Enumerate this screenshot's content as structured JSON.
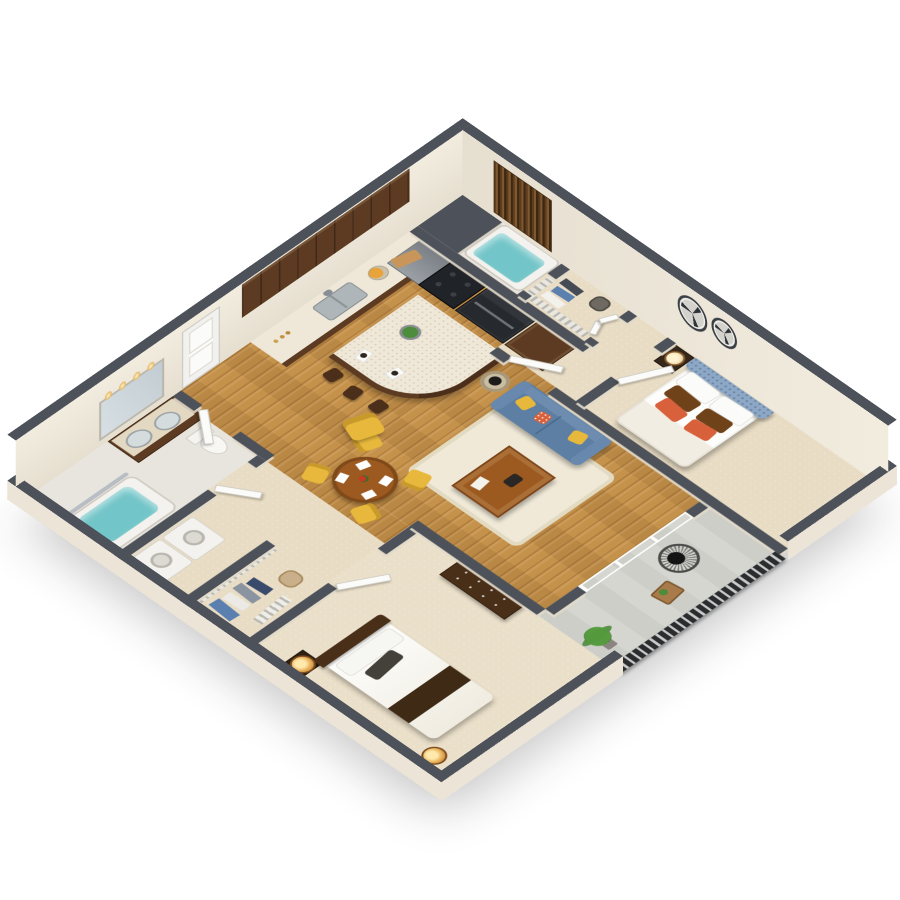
{
  "scene": {
    "type": "3d-floorplan-dollhouse-render",
    "view": "isometric cutaway, two-bedroom two-bath apartment",
    "background": "#ffffff",
    "visible_text": "none"
  },
  "palette": {
    "wall_top_gray": "#4d525a",
    "wall_face_cream": "#efe9dd",
    "wood_floor": "#c5924c",
    "carpet_beige": "#e8dcc4",
    "carpet_bedroom2": "#eadfc9",
    "tile_light": "#e8e5de",
    "patio_concrete": "#d6d6d1",
    "sofa_blue": "#5d7fa3",
    "headboard_blue": "#8ca8c6",
    "chair_yellow": "#e7b83b",
    "tub_water_teal": "#72c5c8",
    "railing_black": "#2a2c2e",
    "fridge_black": "#26292d",
    "cabinet_walnut": "#5d3b22",
    "countertop_cream": "#efe8d8",
    "rug_cream": "#f0e9d8",
    "table_wood": "#9c5a20",
    "runner_brown": "#3e2a15",
    "lamp_gold": "#c07c2e",
    "pillow_orange": "#d8603a",
    "pillow_brown": "#6f421a",
    "plant_green": "#4c8c3a",
    "steel": "#9aa0a5",
    "curtain_brown": "#5e3d1e"
  },
  "rooms": [
    {
      "id": "kitchen",
      "name": "Kitchen",
      "floor": "hardwood"
    },
    {
      "id": "dining-area",
      "name": "Dining Area",
      "floor": "hardwood"
    },
    {
      "id": "living-room",
      "name": "Living Room",
      "floor": "hardwood with cream rug"
    },
    {
      "id": "master-bedroom",
      "name": "Master Bedroom",
      "floor": "beige carpet"
    },
    {
      "id": "master-bathroom",
      "name": "Bathroom 2 (tub/shower)",
      "floor": "tile"
    },
    {
      "id": "master-closet",
      "name": "Walk-in Closet 2 (wire shelving)",
      "floor": "carpet"
    },
    {
      "id": "utility-closet",
      "name": "Utility Closet (gray top)",
      "floor": "n/a"
    },
    {
      "id": "bathroom-1",
      "name": "Bathroom 1 (double vanity, tub)",
      "floor": "tile"
    },
    {
      "id": "laundry",
      "name": "Laundry Nook (washer + dryer)",
      "floor": "carpet"
    },
    {
      "id": "closet-1",
      "name": "Walk-in Closet 1 (wire shelving)",
      "floor": "carpet"
    },
    {
      "id": "bedroom-2",
      "name": "Bedroom 2",
      "floor": "beige carpet"
    },
    {
      "id": "patio",
      "name": "Patio / Balcony",
      "floor": "concrete, black slat railing"
    },
    {
      "id": "hallway",
      "name": "Hallways",
      "floor": "wood / carpet"
    }
  ],
  "furniture": {
    "kitchen": [
      "L-shaped walnut cabinets",
      "upper cabinet band",
      "double stainless sink with faucet",
      "black cooktop range",
      "stainless wall oven / microwave",
      "black refrigerator",
      "walnut pantry cabinet",
      "curved cream quartz island",
      "3 walnut bar stools",
      "green salad bowl",
      "2 white place settings",
      "fruit bowl",
      "cutting board",
      "canisters"
    ],
    "dining-area": [
      "round walnut dining table",
      "4 yellow side chairs",
      "checkered placemats with dark plates",
      "red flower centerpiece",
      "yellow armchair"
    ],
    "living-room": [
      "blue 2-seat sofa",
      "yellow throw pillows",
      "coral patterned pillow",
      "cream area rug",
      "walnut coffee table with books and bowl",
      "round glass side table with black sculpture",
      "sliding glass patio door"
    ],
    "master-bedroom": [
      "blue tufted tall headboard bed",
      "white duvet",
      "2 white pillows",
      "2 brown pillows",
      "2 orange pillows",
      "dark nightstand",
      "lamp with cream shade",
      "2 fan-blade wall clocks",
      "white plantation-shutter windows",
      "yellow window cushion"
    ],
    "master-bathroom": [
      "tub/shower with teal water",
      "brown patterned shower curtain",
      "glass panel"
    ],
    "master-closet": [
      "wire shelving",
      "hanging clothes",
      "storage bin"
    ],
    "bathroom-1": [
      "dark wood double vanity with cream top",
      "two oval sinks",
      "mirror",
      "4-bulb vanity light",
      "toilet",
      "tub with teal water",
      "curved shower rod",
      "shower head"
    ],
    "laundry": [
      "washer",
      "dryer"
    ],
    "closet-1": [
      "wire shelving",
      "hanging clothes (denim, shirts)",
      "wicker basket",
      "shoe rack"
    ],
    "bedroom-2": [
      "bed with dark wood headboard",
      "white bedding",
      "dark brown runner",
      "2 copper drum lamps",
      "dark nightstand",
      "walnut 6-drawer dresser",
      "white plantation-shutter windows"
    ],
    "patio": [
      "black slat railing",
      "round wire chair with black cushion",
      "small wood side table with plant",
      "potted palm"
    ],
    "doors": [
      "white 2-panel entry door (NW wall)",
      "6 open white door leaves",
      "bifold closet doors"
    ]
  }
}
